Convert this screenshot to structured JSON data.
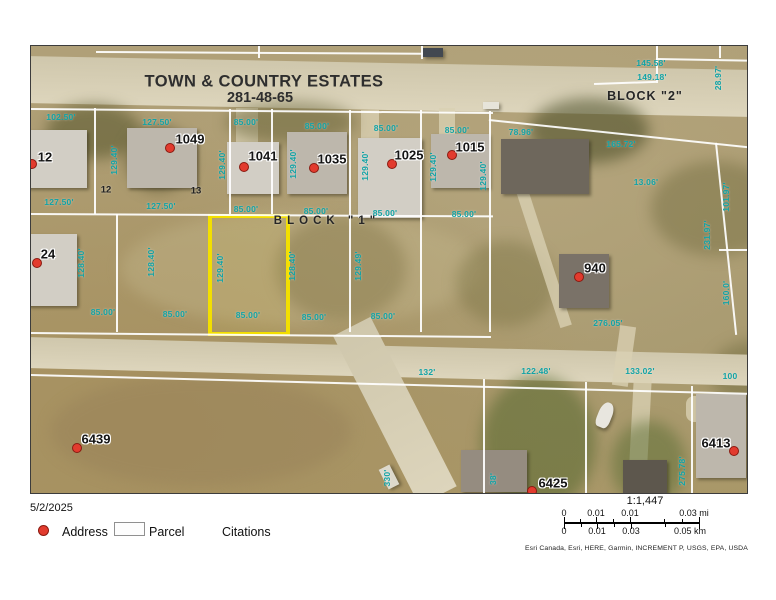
{
  "map": {
    "title": {
      "line1": "TOWN & COUNTRY ESTATES",
      "line2": "281-48-65"
    },
    "block_labels": [
      {
        "text": "BLOCK \"2\"",
        "x": 614,
        "y": 50,
        "ls": 1,
        "fs": 12.5
      },
      {
        "text": "BLOCK \"1\"",
        "x": 296,
        "y": 175,
        "ls": 5,
        "fs": 11.5
      }
    ],
    "addresses": [
      {
        "label": "12",
        "x": 14,
        "y": 111,
        "dx": 1,
        "dy": 118
      },
      {
        "label": "1049",
        "x": 159,
        "y": 93,
        "dx": 139,
        "dy": 102
      },
      {
        "label": "1041",
        "x": 232,
        "y": 110,
        "dx": 213,
        "dy": 121
      },
      {
        "label": "1035",
        "x": 301,
        "y": 113,
        "dx": 283,
        "dy": 122
      },
      {
        "label": "1025",
        "x": 378,
        "y": 109,
        "dx": 361,
        "dy": 118
      },
      {
        "label": "1015",
        "x": 439,
        "y": 101,
        "dx": 421,
        "dy": 109
      },
      {
        "label": "940",
        "x": 564,
        "y": 222,
        "dx": 548,
        "dy": 231
      },
      {
        "label": "24",
        "x": 17,
        "y": 208,
        "dx": 6,
        "dy": 217
      },
      {
        "label": "6439",
        "x": 65,
        "y": 393,
        "dx": 46,
        "dy": 402
      },
      {
        "label": "6425",
        "x": 522,
        "y": 437,
        "dx": 501,
        "dy": 445
      },
      {
        "label": "6413",
        "x": 685,
        "y": 397,
        "dx": 703,
        "dy": 405
      }
    ],
    "lot_numbers": [
      {
        "t": "12",
        "x": 75,
        "y": 144
      },
      {
        "t": "13",
        "x": 165,
        "y": 145
      }
    ],
    "dimensions": [
      {
        "t": "102.50'",
        "x": 30,
        "y": 71
      },
      {
        "t": "127.50'",
        "x": 126,
        "y": 76
      },
      {
        "t": "85.00'",
        "x": 215,
        "y": 76
      },
      {
        "t": "85.00'",
        "x": 286,
        "y": 80
      },
      {
        "t": "85.00'",
        "x": 355,
        "y": 82
      },
      {
        "t": "85.00'",
        "x": 426,
        "y": 84
      },
      {
        "t": "145.58'",
        "x": 620,
        "y": 17
      },
      {
        "t": "149.18'",
        "x": 621,
        "y": 31
      },
      {
        "t": "28.97'",
        "x": 687,
        "y": 32,
        "v": true
      },
      {
        "t": "127.50'",
        "x": 28,
        "y": 156
      },
      {
        "t": "127.50'",
        "x": 130,
        "y": 160
      },
      {
        "t": "85.00'",
        "x": 285,
        "y": 165
      },
      {
        "t": "85.00'",
        "x": 354,
        "y": 167
      },
      {
        "t": "85.00'",
        "x": 433,
        "y": 168
      },
      {
        "t": "78.96'",
        "x": 490,
        "y": 86
      },
      {
        "t": "165.72'",
        "x": 590,
        "y": 98
      },
      {
        "t": "13.06'",
        "x": 615,
        "y": 136
      },
      {
        "t": "101.97'",
        "x": 695,
        "y": 151,
        "v": true
      },
      {
        "t": "231.97'",
        "x": 676,
        "y": 189,
        "v": true
      },
      {
        "t": "160.0'",
        "x": 695,
        "y": 247,
        "v": true
      },
      {
        "t": "129.40'",
        "x": 83,
        "y": 114,
        "v": true
      },
      {
        "t": "129.40'",
        "x": 191,
        "y": 119,
        "v": true
      },
      {
        "t": "129.40'",
        "x": 262,
        "y": 118,
        "v": true
      },
      {
        "t": "129.40'",
        "x": 334,
        "y": 120,
        "v": true
      },
      {
        "t": "129.40'",
        "x": 402,
        "y": 121,
        "v": true
      },
      {
        "t": "129.40'",
        "x": 452,
        "y": 130,
        "v": true
      },
      {
        "t": "85.00'",
        "x": 215,
        "y": 163
      },
      {
        "t": "128.40'",
        "x": 50,
        "y": 217,
        "v": true
      },
      {
        "t": "128.40'",
        "x": 120,
        "y": 216,
        "v": true
      },
      {
        "t": "129.40'",
        "x": 189,
        "y": 222,
        "v": true
      },
      {
        "t": "128.40'",
        "x": 261,
        "y": 220,
        "v": true
      },
      {
        "t": "129.49'",
        "x": 327,
        "y": 220,
        "v": true
      },
      {
        "t": "85.00'",
        "x": -12,
        "y": 265
      },
      {
        "t": "85.00'",
        "x": 72,
        "y": 266
      },
      {
        "t": "85.00'",
        "x": 144,
        "y": 268
      },
      {
        "t": "85.00'",
        "x": 217,
        "y": 269
      },
      {
        "t": "85.00'",
        "x": 283,
        "y": 271
      },
      {
        "t": "85.00'",
        "x": 352,
        "y": 270
      },
      {
        "t": "276.05'",
        "x": 577,
        "y": 277
      },
      {
        "t": "132'",
        "x": 396,
        "y": 326
      },
      {
        "t": "122.48'",
        "x": 505,
        "y": 325
      },
      {
        "t": "133.02'",
        "x": 609,
        "y": 325
      },
      {
        "t": "100",
        "x": 699,
        "y": 330
      },
      {
        "t": "330'",
        "x": 356,
        "y": 432,
        "v": true
      },
      {
        "t": "38'",
        "x": 462,
        "y": 433,
        "v": true
      },
      {
        "t": "275.78'",
        "x": 651,
        "y": 425,
        "v": true
      }
    ],
    "parcel_lines": [
      {
        "d": "h",
        "x": 65,
        "y": 5,
        "l": 327,
        "r": 0.3
      },
      {
        "d": "v",
        "x": 227,
        "y": 0,
        "l": 12,
        "r": 0
      },
      {
        "d": "v",
        "x": 390,
        "y": 0,
        "l": 13,
        "r": 0
      },
      {
        "d": "h",
        "x": 563,
        "y": 37,
        "l": 62,
        "r": -2
      },
      {
        "d": "v",
        "x": 625,
        "y": 0,
        "l": 37,
        "r": 0
      },
      {
        "d": "h",
        "x": 625,
        "y": 12,
        "l": 91,
        "r": 1
      },
      {
        "d": "v",
        "x": 688,
        "y": 0,
        "l": 12,
        "r": 0
      },
      {
        "d": "h",
        "x": 0,
        "y": 62,
        "l": 462,
        "r": 0.5
      },
      {
        "d": "h",
        "x": 0,
        "y": 167,
        "l": 462,
        "r": 0.3
      },
      {
        "d": "v",
        "x": 63,
        "y": 62,
        "l": 106,
        "r": 0
      },
      {
        "d": "v",
        "x": 198,
        "y": 63,
        "l": 105,
        "r": 0
      },
      {
        "d": "v",
        "x": 240,
        "y": 63,
        "l": 105,
        "r": 0
      },
      {
        "d": "v",
        "x": 318,
        "y": 64,
        "l": 222,
        "r": 0
      },
      {
        "d": "v",
        "x": 389,
        "y": 64,
        "l": 222,
        "r": 0
      },
      {
        "d": "v",
        "x": 458,
        "y": 65,
        "l": 221,
        "r": 0
      },
      {
        "d": "v",
        "x": 85,
        "y": 168,
        "l": 118,
        "r": 0
      },
      {
        "d": "h",
        "x": 458,
        "y": 73,
        "l": 262,
        "r": 6
      },
      {
        "d": "v",
        "x": 684,
        "y": 97,
        "l": 193,
        "r": -6
      },
      {
        "d": "h",
        "x": 688,
        "y": 203,
        "l": 30,
        "r": 0
      },
      {
        "d": "h",
        "x": 0,
        "y": 286,
        "l": 460,
        "r": 0.5
      },
      {
        "d": "h",
        "x": 0,
        "y": 328,
        "l": 718,
        "r": 1.5
      },
      {
        "d": "v",
        "x": 452,
        "y": 333,
        "l": 114,
        "r": 0
      },
      {
        "d": "v",
        "x": 554,
        "y": 336,
        "l": 111,
        "r": 0
      },
      {
        "d": "v",
        "x": 660,
        "y": 340,
        "l": 107,
        "r": 0
      }
    ],
    "colors": {
      "dimension_teal": "#12a3a6",
      "address_dot_red": "#e23b2e",
      "highlight_yellow": "#f3df00"
    }
  },
  "footer": {
    "date": "5/2/2025",
    "legend": {
      "address_label": "Address",
      "parcel_label": "Parcel",
      "citations_label": "Citations"
    },
    "scale": {
      "ratio": "1:1,447",
      "mi": [
        "0",
        "0.01",
        "0.01",
        "0.03 mi"
      ],
      "km": [
        "0",
        "0.01",
        "0.03",
        "0.05 km"
      ],
      "attribution": "Esri Canada, Esri, HERE, Garmin, INCREMENT P, USGS, EPA, USDA"
    }
  }
}
